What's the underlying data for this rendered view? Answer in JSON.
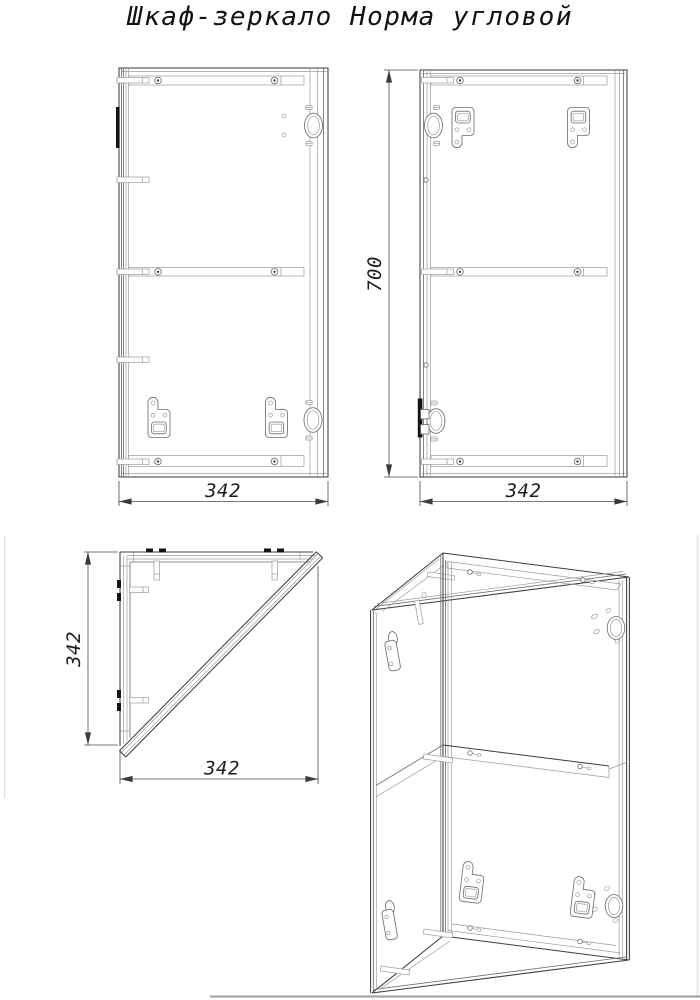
{
  "title": "Шкаф-зеркало Норма угловой",
  "dimensions": {
    "front_width": "342",
    "back_width": "342",
    "back_height": "700",
    "plan_depth": "342",
    "plan_width": "342"
  },
  "colors": {
    "line": "#3e3e3e",
    "thin_line": "#9c9c9c",
    "background": "#ffffff",
    "page_edge": "#ededed",
    "bottom_rule": "#9aa0a6"
  }
}
